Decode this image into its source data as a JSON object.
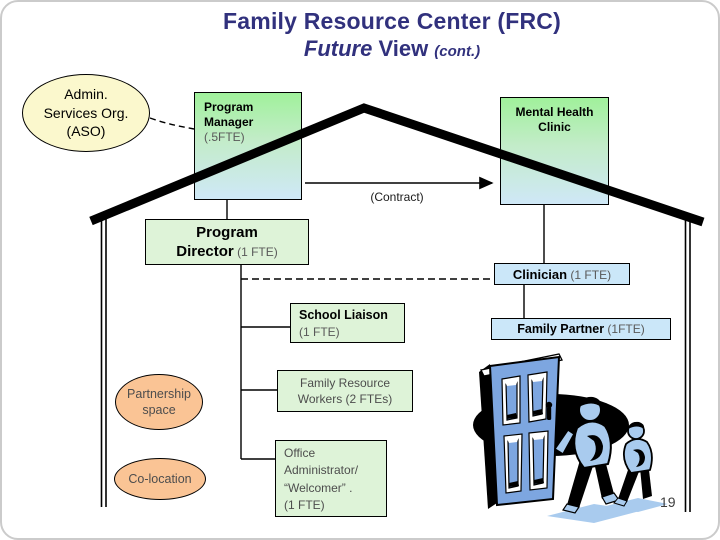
{
  "title": {
    "line1": "Family Resource Center (FRC)",
    "line2_future": "Future",
    "line2_view": " View ",
    "line2_cont": "(cont.)"
  },
  "aso": {
    "line1": "Admin.",
    "line2": "Services Org.",
    "line3": "(ASO)"
  },
  "program_manager": {
    "title": "Program Manager",
    "fte": "(.5FTE)"
  },
  "mental_health_clinic": {
    "title": "Mental Health Clinic"
  },
  "contract": {
    "label": "(Contract)"
  },
  "program_director": {
    "line1": "Program",
    "line2": "Director",
    "fte": " (1 FTE)"
  },
  "clinician": {
    "title": "Clinician",
    "fte": " (1 FTE)"
  },
  "school_liaison": {
    "title": "School Liaison",
    "fte": "(1 FTE)"
  },
  "family_partner": {
    "title": "Family Partner",
    "fte": " (1FTE)"
  },
  "family_resource_workers": {
    "line1": "Family Resource",
    "line2": "Workers (2 FTEs)"
  },
  "partnership_space": {
    "line1": "Partnership",
    "line2": "space"
  },
  "co_location": {
    "label": "Co-location"
  },
  "office_administrator": {
    "line1": "Office",
    "line2": "Administrator/",
    "line3": "“Welcomer” .",
    "line4": "(1 FTE)"
  },
  "page_number": "19",
  "colors": {
    "title_text": "#31317d",
    "gradient_box_top": "#a0f19b",
    "gradient_box_bottom": "#cfe8f7",
    "pale_green_box": "#def3d8",
    "pale_blue_box": "#cbe7f9",
    "cream_ellipse": "#fbf8cd",
    "peach_ellipse": "#fac495",
    "door_blue": "#7da6e0",
    "figure_blue": "#a9cbee",
    "line_black": "#000000"
  }
}
